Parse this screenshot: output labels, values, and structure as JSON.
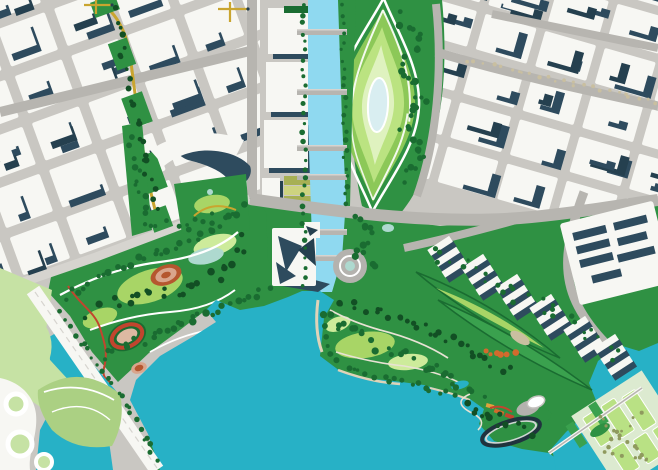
{
  "palette": {
    "base": "#c9c7c2",
    "blockWhite": "#f7f7f3",
    "shadow": "#2e4b5e",
    "shadowDeep": "#25404f",
    "road": "#b7b5b0",
    "roadLight": "#d6d4cf",
    "canal": "#8fd9f0",
    "bay": "#27b1c6",
    "green": "#2f9143",
    "treeDark": "#1a6c31",
    "treeDeep": "#124f24",
    "lawn": "#a8d566",
    "lawnPale": "#cdeb9b",
    "mint": "#aed9cf",
    "ringMid": "#8cc858",
    "ringLight": "#bbe381",
    "ringPale": "#dff2bf",
    "pond": "#d9eef1",
    "olive": "#a7b054",
    "oliveLight": "#cdd37f",
    "yellow": "#c9a52f",
    "red": "#c2452e",
    "terracotta": "#b5572f",
    "clay": "#d9a58c",
    "trackInfield": "#dcb9a2",
    "orange": "#d26a2d",
    "amber": "#e0a23c",
    "beige": "#e6dcc4",
    "sand": "#dfd3b8",
    "ringDark": "#20333e",
    "plaza": "#b4b2ae",
    "white": "#ffffff",
    "leaf": "#abd083",
    "leafPale": "#c6e2a4",
    "formalLawn": "#b9e184",
    "dotOlive": "#8f9a5e",
    "dotBeige": "#c9bfa0",
    "pierGreen": "#3aa14e"
  },
  "map": {
    "districts": [
      {
        "host": "district-northwest-blocks",
        "rotation": -20,
        "cx": 130,
        "cy": 130,
        "x0": -210,
        "y0": -190,
        "cols": 7,
        "rows": 7,
        "cellW": 60,
        "cellH": 50,
        "gap": 10,
        "seed": 7,
        "shadow": [
          2.6,
          7.3
        ],
        "clip": [
          [
            0,
            0
          ],
          [
            260,
            0
          ],
          [
            260,
            200
          ],
          [
            96,
            260
          ],
          [
            0,
            294
          ]
        ]
      },
      {
        "host": "district-northeast-blocks",
        "rotation": 16,
        "cx": 540,
        "cy": 100,
        "x0": -200,
        "y0": -160,
        "cols": 6,
        "rows": 6,
        "cellW": 62,
        "cellH": 46,
        "gap": 9,
        "seed": 3,
        "shadow": [
          9,
          4.5
        ],
        "clip": [
          [
            426,
            0
          ],
          [
            658,
            0
          ],
          [
            658,
            196
          ],
          [
            520,
            214
          ],
          [
            426,
            196
          ],
          [
            414,
            118
          ],
          [
            420,
            40
          ]
        ]
      }
    ],
    "canal": {
      "bridgeX": 297,
      "bridgeW": 50,
      "bridges": [
        32,
        92,
        148,
        177,
        232,
        258
      ]
    },
    "residentialClusters": [
      [
        448,
        258
      ],
      [
        482,
        276
      ],
      [
        516,
        296
      ],
      [
        550,
        316
      ],
      [
        584,
        338
      ],
      [
        614,
        356
      ]
    ],
    "warehouse": {
      "rotation": [
        -14,
        612,
        252
      ],
      "backdrop": [
        568,
        212,
        96,
        84
      ],
      "slabs": [
        [
          578,
          224,
          34,
          8
        ],
        [
          578,
          238,
          34,
          8
        ],
        [
          578,
          252,
          34,
          8
        ],
        [
          620,
          224,
          34,
          8
        ],
        [
          620,
          240,
          30,
          8
        ],
        [
          616,
          256,
          38,
          8
        ],
        [
          586,
          270,
          30,
          8
        ]
      ]
    },
    "formalLawns": {
      "rotation": [
        -33,
        616,
        430
      ],
      "backdrop": [
        586,
        394,
        84,
        88
      ],
      "lawns": [
        [
          594,
          402,
          16,
          34
        ],
        [
          616,
          402,
          16,
          38
        ],
        [
          638,
          406,
          16,
          40
        ],
        [
          600,
          444,
          16,
          30
        ],
        [
          624,
          448,
          16,
          28
        ],
        [
          646,
          450,
          14,
          26
        ]
      ]
    },
    "treeBands": [
      {
        "name": "canal-west-trees",
        "pts": [
          [
            304,
            6
          ],
          [
            304,
            286
          ]
        ],
        "step": 9,
        "r": 2.2,
        "spread": 2,
        "color": "treeDark"
      },
      {
        "name": "canal-east-trees",
        "pts": [
          [
            342,
            6
          ],
          [
            346,
            204
          ]
        ],
        "step": 9,
        "r": 2.2,
        "spread": 2,
        "color": "treeDark"
      },
      {
        "name": "oval-park-grove",
        "pts": [
          [
            400,
            16
          ],
          [
            420,
            42
          ],
          [
            402,
            72
          ],
          [
            424,
            98
          ],
          [
            404,
            126
          ],
          [
            422,
            154
          ],
          [
            402,
            180
          ]
        ],
        "step": 6,
        "r": 3,
        "spread": 5,
        "color": "treeDark"
      },
      {
        "name": "west-park-north-trees",
        "pts": [
          [
            66,
            296
          ],
          [
            110,
            272
          ],
          [
            160,
            252
          ],
          [
            210,
            230
          ],
          [
            246,
            208
          ]
        ],
        "step": 7,
        "r": 2.8,
        "spread": 4,
        "color": "treeDark"
      },
      {
        "name": "west-park-mid-trees",
        "pts": [
          [
            84,
            312
          ],
          [
            130,
            300
          ],
          [
            178,
            292
          ],
          [
            226,
            270
          ],
          [
            248,
            242
          ]
        ],
        "step": 8,
        "r": 3,
        "spread": 8,
        "color": "treeDeep"
      },
      {
        "name": "west-park-south-trees",
        "pts": [
          [
            104,
            356
          ],
          [
            150,
            336
          ],
          [
            196,
            316
          ],
          [
            240,
            298
          ],
          [
            268,
            288
          ]
        ],
        "step": 7,
        "r": 3,
        "spread": 6,
        "color": "treeDark"
      },
      {
        "name": "peninsula-trees-a",
        "pts": [
          [
            322,
            312
          ],
          [
            352,
            332
          ],
          [
            388,
            348
          ],
          [
            424,
            364
          ],
          [
            456,
            380
          ],
          [
            478,
            398
          ]
        ],
        "step": 7,
        "r": 2.8,
        "spread": 7,
        "color": "treeDark"
      },
      {
        "name": "peninsula-trees-b",
        "pts": [
          [
            338,
            302
          ],
          [
            374,
            312
          ],
          [
            410,
            322
          ],
          [
            444,
            336
          ],
          [
            478,
            352
          ],
          [
            506,
            372
          ]
        ],
        "step": 7,
        "r": 2.6,
        "spread": 6,
        "color": "treeDeep"
      },
      {
        "name": "shoreline-trees",
        "pts": [
          [
            324,
            326
          ],
          [
            330,
            356
          ],
          [
            356,
            372
          ],
          [
            392,
            380
          ],
          [
            428,
            388
          ],
          [
            458,
            396
          ]
        ],
        "step": 8,
        "r": 2.4,
        "spread": 3,
        "color": "treeDark"
      },
      {
        "name": "marina-grove",
        "pts": [
          [
            466,
            404
          ],
          [
            488,
            416
          ],
          [
            510,
            424
          ],
          [
            528,
            432
          ]
        ],
        "step": 6,
        "r": 2.8,
        "spread": 5,
        "color": "treeDeep"
      },
      {
        "name": "residential-garden-trees",
        "pts": [
          [
            432,
            252
          ],
          [
            472,
            270
          ],
          [
            512,
            292
          ],
          [
            552,
            314
          ],
          [
            590,
            338
          ],
          [
            618,
            356
          ]
        ],
        "step": 8,
        "r": 2.2,
        "spread": 9,
        "color": "treeDark"
      },
      {
        "name": "construction-park-trees",
        "pts": [
          [
            114,
            10
          ],
          [
            124,
            56
          ],
          [
            136,
            108
          ],
          [
            146,
            164
          ],
          [
            156,
            212
          ]
        ],
        "step": 9,
        "r": 2.5,
        "spread": 4,
        "color": "treeDeep"
      },
      {
        "name": "curved-park-trees",
        "pts": [
          [
            130,
            140
          ],
          [
            138,
            182
          ],
          [
            148,
            222
          ],
          [
            186,
            226
          ],
          [
            222,
            214
          ]
        ],
        "step": 8,
        "r": 2.6,
        "spread": 4,
        "color": "treeDark"
      },
      {
        "name": "highway-side-trees",
        "pts": [
          [
            58,
            314
          ],
          [
            84,
            344
          ],
          [
            108,
            376
          ],
          [
            128,
            406
          ],
          [
            146,
            438
          ],
          [
            156,
            462
          ]
        ],
        "step": 8,
        "r": 2.2,
        "spread": 3,
        "color": "treeDark"
      },
      {
        "name": "ne-boulevard-trees",
        "pts": [
          [
            466,
            60
          ],
          [
            520,
            72
          ],
          [
            574,
            84
          ],
          [
            628,
            96
          ],
          [
            656,
            102
          ]
        ],
        "step": 9,
        "r": 1.8,
        "spread": 2,
        "color": "dotBeige"
      },
      {
        "name": "formal-park-trees",
        "pts": [
          [
            598,
            414
          ],
          [
            616,
            430
          ],
          [
            634,
            446
          ],
          [
            650,
            458
          ],
          [
            606,
            448
          ],
          [
            640,
            414
          ]
        ],
        "step": 8,
        "r": 1.8,
        "spread": 4,
        "color": "dotOlive"
      },
      {
        "name": "east-bank-grove",
        "pts": [
          [
            352,
            214
          ],
          [
            372,
            232
          ],
          [
            360,
            252
          ],
          [
            376,
            268
          ]
        ],
        "step": 6,
        "r": 2.8,
        "spread": 5,
        "color": "treeDark"
      },
      {
        "name": "terracotta-grove",
        "pts": [
          [
            484,
            350
          ],
          [
            500,
            356
          ],
          [
            514,
            352
          ]
        ],
        "step": 6,
        "r": 2.6,
        "spread": 3,
        "color": "orange"
      }
    ]
  }
}
